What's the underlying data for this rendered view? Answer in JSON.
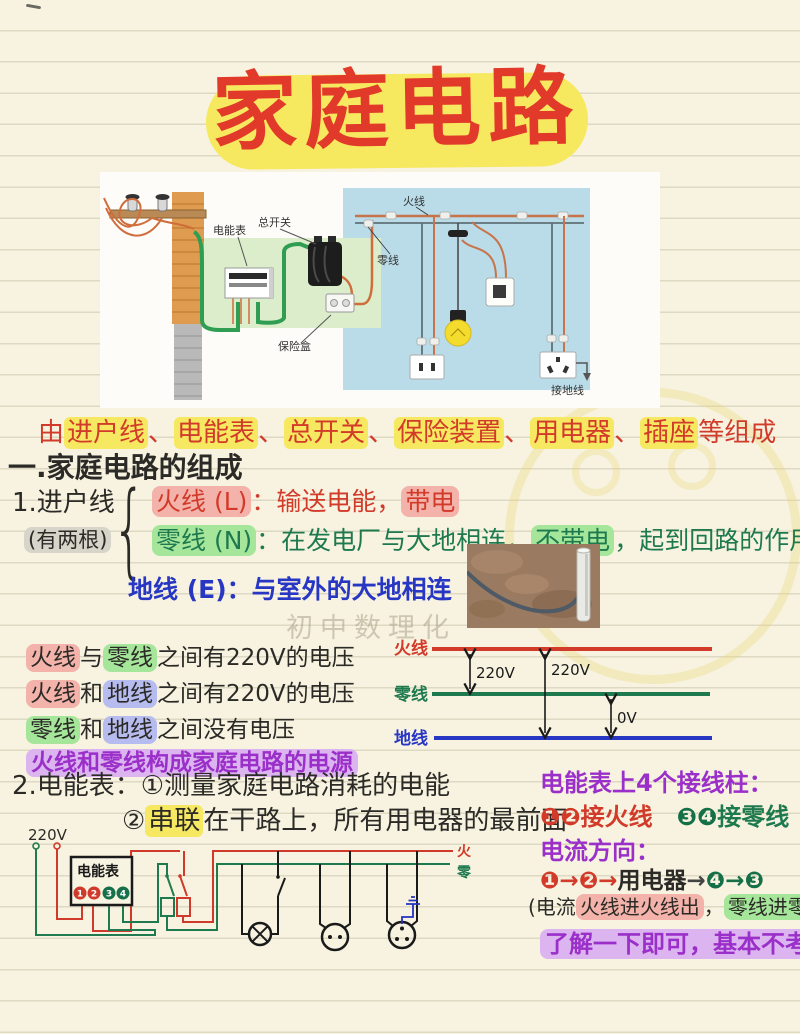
{
  "title": "家庭电路",
  "watermark": "初中数理化",
  "illustration": {
    "meter_label": "电能表",
    "main_switch_label": "总开关",
    "fuse_label": "保险盒",
    "live_label": "火线",
    "neutral_label": "零线",
    "ground_label": "接地线"
  },
  "composition": {
    "segments": [
      {
        "text": "由",
        "style": "red"
      },
      {
        "text": "进户线",
        "style": "red hl-yellow"
      },
      {
        "text": "、",
        "style": "red"
      },
      {
        "text": "电能表",
        "style": "red hl-yellow"
      },
      {
        "text": "、",
        "style": "red"
      },
      {
        "text": "总开关",
        "style": "red hl-yellow"
      },
      {
        "text": "、",
        "style": "red"
      },
      {
        "text": "保险装置",
        "style": "red hl-yellow"
      },
      {
        "text": "、",
        "style": "red"
      },
      {
        "text": "用电器",
        "style": "red hl-yellow"
      },
      {
        "text": "、",
        "style": "red"
      },
      {
        "text": "插座",
        "style": "red hl-yellow"
      },
      {
        "text": "等组成",
        "style": "red"
      }
    ]
  },
  "section1": {
    "heading": "一.家庭电路的组成",
    "item_label": "1.进户线",
    "item_sub_segments": [
      {
        "text": "(有两根)",
        "style": "black hl-gray"
      }
    ],
    "brace": "{",
    "live_segments": [
      {
        "text": "火线 (L)",
        "style": "red hl-pink"
      },
      {
        "text": "：输送电能，",
        "style": "red"
      },
      {
        "text": "带电",
        "style": "red hl-pink"
      }
    ],
    "neutral_segments": [
      {
        "text": "零线 (N)",
        "style": "green hl-green"
      },
      {
        "text": "：在发电厂与大地相连，",
        "style": "green"
      },
      {
        "text": "不带电",
        "style": "green hl-green"
      },
      {
        "text": "，起到回路的作用",
        "style": "green"
      }
    ],
    "earth_segments": [
      {
        "text": "地线 (E)：与室外的大地相连",
        "style": "blue"
      }
    ]
  },
  "voltage_notes": {
    "line1": [
      {
        "text": "火线",
        "style": "black hl-pink"
      },
      {
        "text": "与",
        "style": "black"
      },
      {
        "text": "零线",
        "style": "black hl-green"
      },
      {
        "text": "之间有220V的电压",
        "style": "black"
      }
    ],
    "line2": [
      {
        "text": "火线",
        "style": "black hl-pink"
      },
      {
        "text": "和",
        "style": "black"
      },
      {
        "text": "地线",
        "style": "black hl-blue"
      },
      {
        "text": "之间有220V的电压",
        "style": "black"
      }
    ],
    "line3": [
      {
        "text": "零线",
        "style": "black hl-green"
      },
      {
        "text": "和",
        "style": "black"
      },
      {
        "text": "地线",
        "style": "black hl-blue"
      },
      {
        "text": "之间没有电压",
        "style": "black"
      }
    ],
    "line4": [
      {
        "text": "火线和零线构成家庭电路的电源",
        "style": "purple hl-purple"
      }
    ]
  },
  "voltage_diagram": {
    "live_label": "火线",
    "neutral_label": "零线",
    "ground_label": "地线",
    "v_live_neutral": "220V",
    "v_live_ground": "220V",
    "v_neutral_ground": "0V"
  },
  "section2": {
    "line1": "2.电能表：①测量家庭电路消耗的电能",
    "line2_segments": [
      {
        "text": "②",
        "style": "black"
      },
      {
        "text": "串联",
        "style": "black hl-yellow"
      },
      {
        "text": "在干路上，所有用电器的最前面",
        "style": "black"
      }
    ]
  },
  "meter_column": {
    "line1": "电能表上4个接线柱：",
    "line2_segments": [
      {
        "text": "❶❷",
        "style": "circ-red"
      },
      {
        "text": "接火线",
        "style": "red"
      },
      {
        "text": "　",
        "style": "black"
      },
      {
        "text": "❸❹",
        "style": "circ-green"
      },
      {
        "text": "接零线",
        "style": "green"
      }
    ],
    "line3": "电流方向：",
    "line4_segments": [
      {
        "text": "❶→❷→",
        "style": "circ-red"
      },
      {
        "text": "用电器",
        "style": "black"
      },
      {
        "text": "→",
        "style": "arrow-dark"
      },
      {
        "text": "❹",
        "style": "circ-green"
      },
      {
        "text": "→",
        "style": "arrow-green"
      },
      {
        "text": "❸",
        "style": "circ-green"
      }
    ],
    "line5_segments": [
      {
        "text": "(电流",
        "style": "black"
      },
      {
        "text": "火线进火线出",
        "style": "black hl-pink"
      },
      {
        "text": "，",
        "style": "black"
      },
      {
        "text": "零线进零线出",
        "style": "black hl-green"
      }
    ],
    "line6_segments": [
      {
        "text": "了解一下即可，基本不考",
        "style": "purple hl-purple"
      }
    ]
  },
  "bottom_circuit": {
    "source_label": "220V",
    "meter_label": "电能表",
    "terminals": [
      "1",
      "2",
      "3",
      "4"
    ],
    "live_label": "火",
    "neutral_label": "零"
  },
  "colors": {
    "accent_red": "#d23a2a",
    "accent_green": "#1e7a4e",
    "accent_blue": "#2836c4",
    "accent_purple": "#9b2fc9",
    "highlight_yellow": "#f6e860"
  }
}
